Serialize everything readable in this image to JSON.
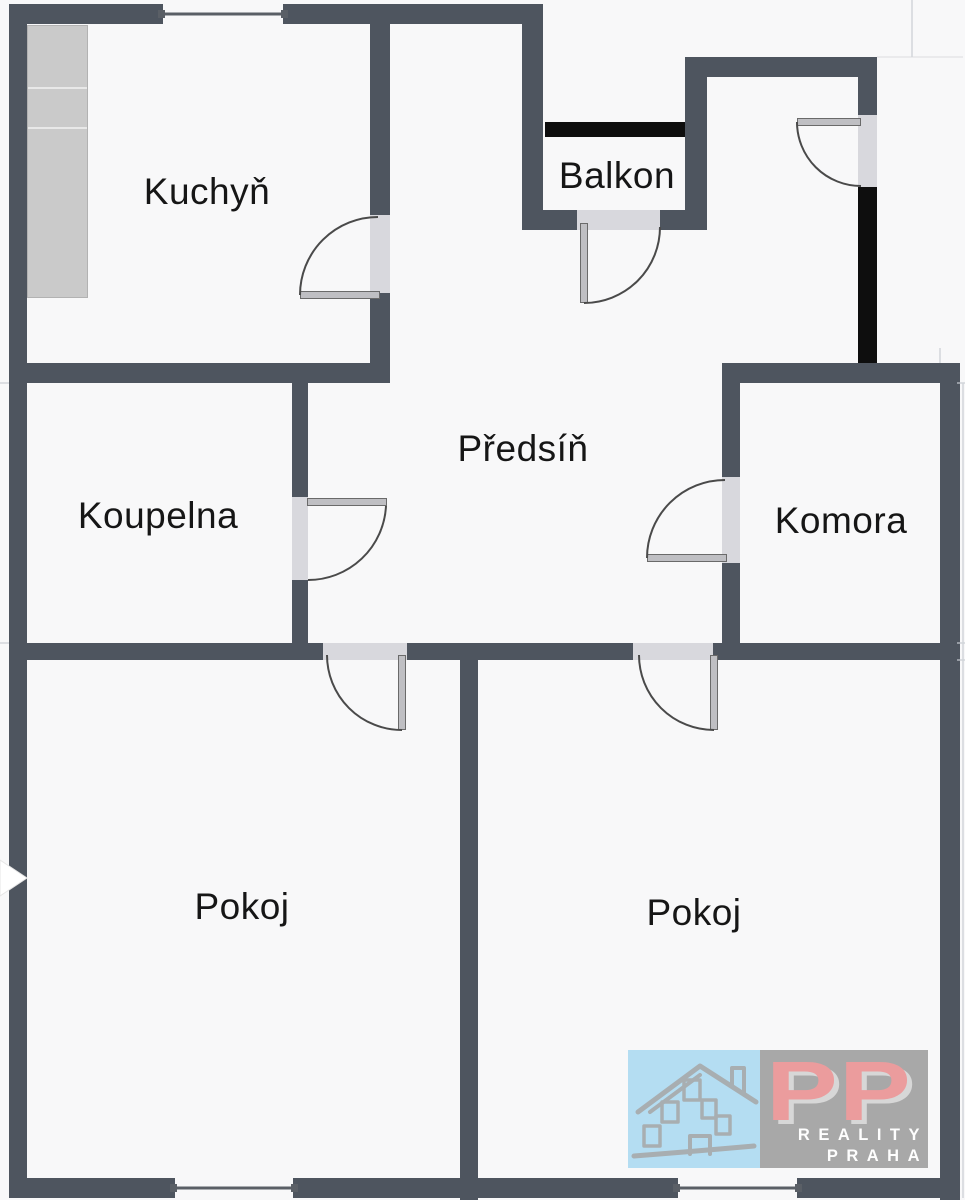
{
  "floorplan": {
    "rooms": [
      {
        "id": "kuchyn",
        "label": "Kuchyň"
      },
      {
        "id": "balkon",
        "label": "Balkon"
      },
      {
        "id": "predsin",
        "label": "Předsíň"
      },
      {
        "id": "koupelna",
        "label": "Koupelna"
      },
      {
        "id": "komora",
        "label": "Komora"
      },
      {
        "id": "pokoj-left",
        "label": "Pokoj"
      },
      {
        "id": "pokoj-right",
        "label": "Pokoj"
      }
    ],
    "logo": {
      "monogram": "PP",
      "line1": "REALITY",
      "line2": "PRAHA"
    },
    "colors": {
      "background": "#f8f8f9",
      "wall": "#4e555f",
      "black_seg": "#0e0e0e",
      "opening": "#d8d8dd",
      "leaf": "#bfbfc3",
      "leaf_border": "#6a6a6a",
      "counter": "#cacaca",
      "counter_border": "#b2b2b2",
      "arc": "#4a4a4a",
      "window_line": "#5a5f66",
      "faint": "#c8cdd2",
      "label": "#161616",
      "logo_blue": "#a9d9f1",
      "logo_gray": "#9b9b9b",
      "logo_red": "#e98c8e",
      "logo_text": "#ffffff",
      "house_stroke": "#9aa1a5"
    }
  }
}
